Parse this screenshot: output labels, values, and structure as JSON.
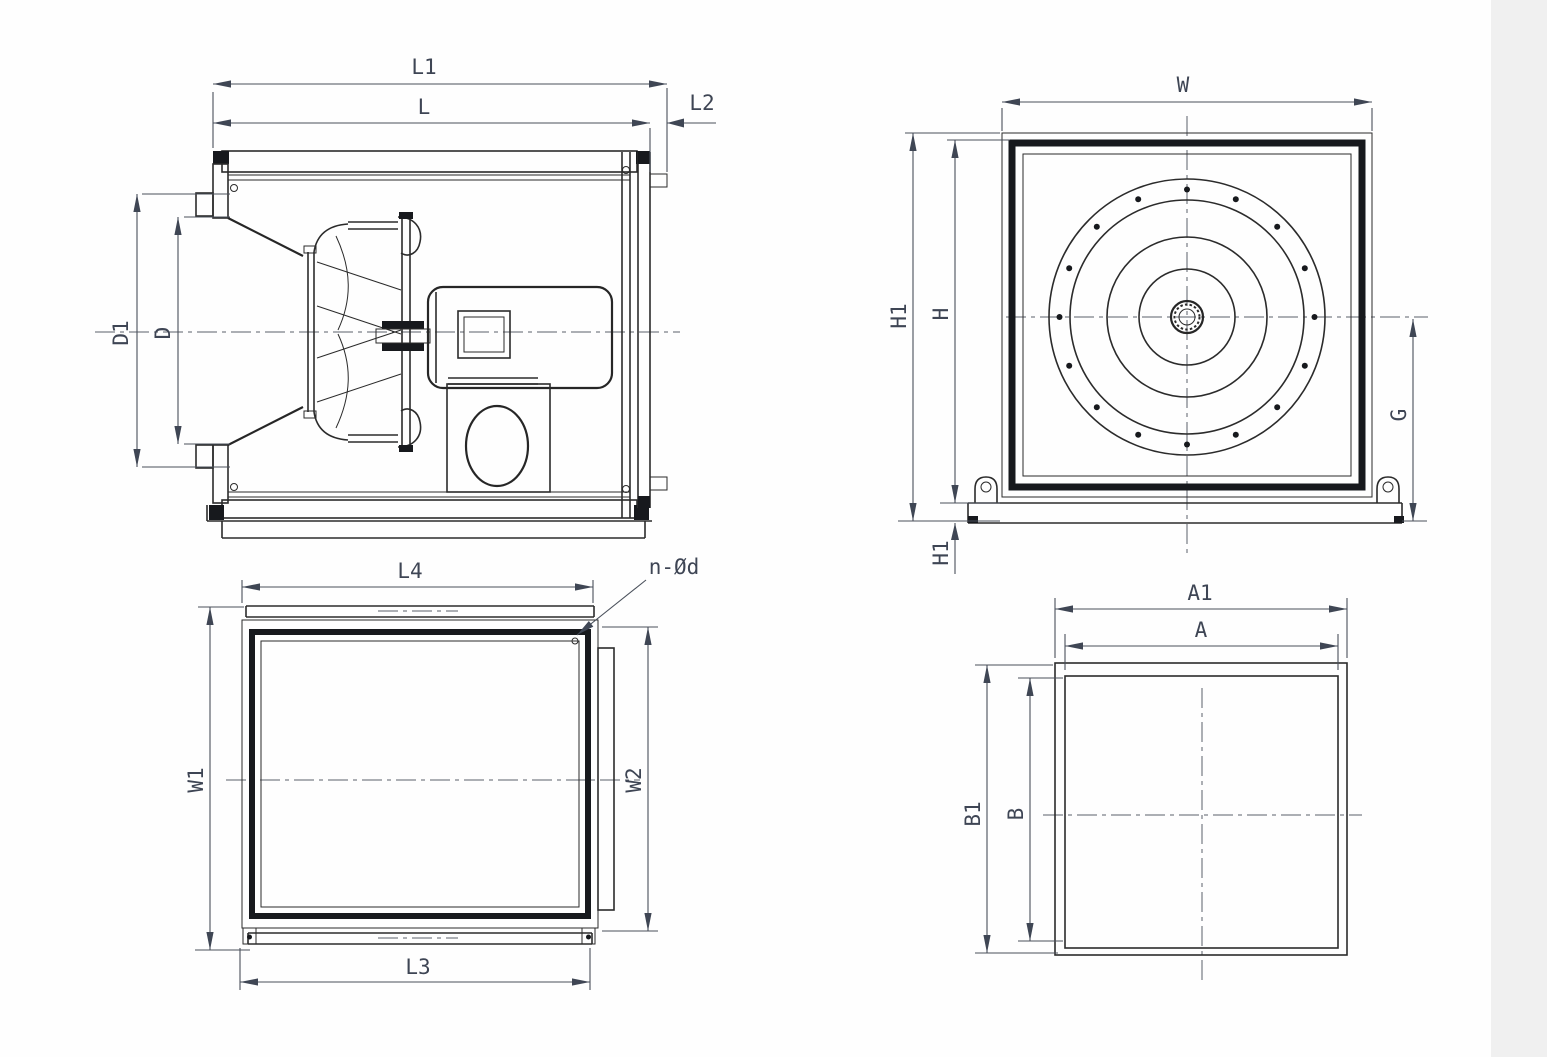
{
  "drawing": {
    "subject": "box centrifugal fan dimensional drawing",
    "bg_color": "#fefefe",
    "line_color": "#2b2b2b",
    "dim_text_color": "#3e4554"
  },
  "dims": {
    "side": {
      "L1": "L1",
      "L": "L",
      "L2": "L2",
      "D1": "D1",
      "D": "D"
    },
    "front": {
      "W": "W",
      "H1": "H1",
      "H": "H",
      "H1_base": "H1",
      "G": "G"
    },
    "inlet": {
      "L4": "L4",
      "bolt_note": "n-Ød",
      "W1": "W1",
      "W2": "W2",
      "L3": "L3"
    },
    "flange": {
      "A1": "A1",
      "A": "A",
      "B1": "B1",
      "B": "B"
    }
  }
}
